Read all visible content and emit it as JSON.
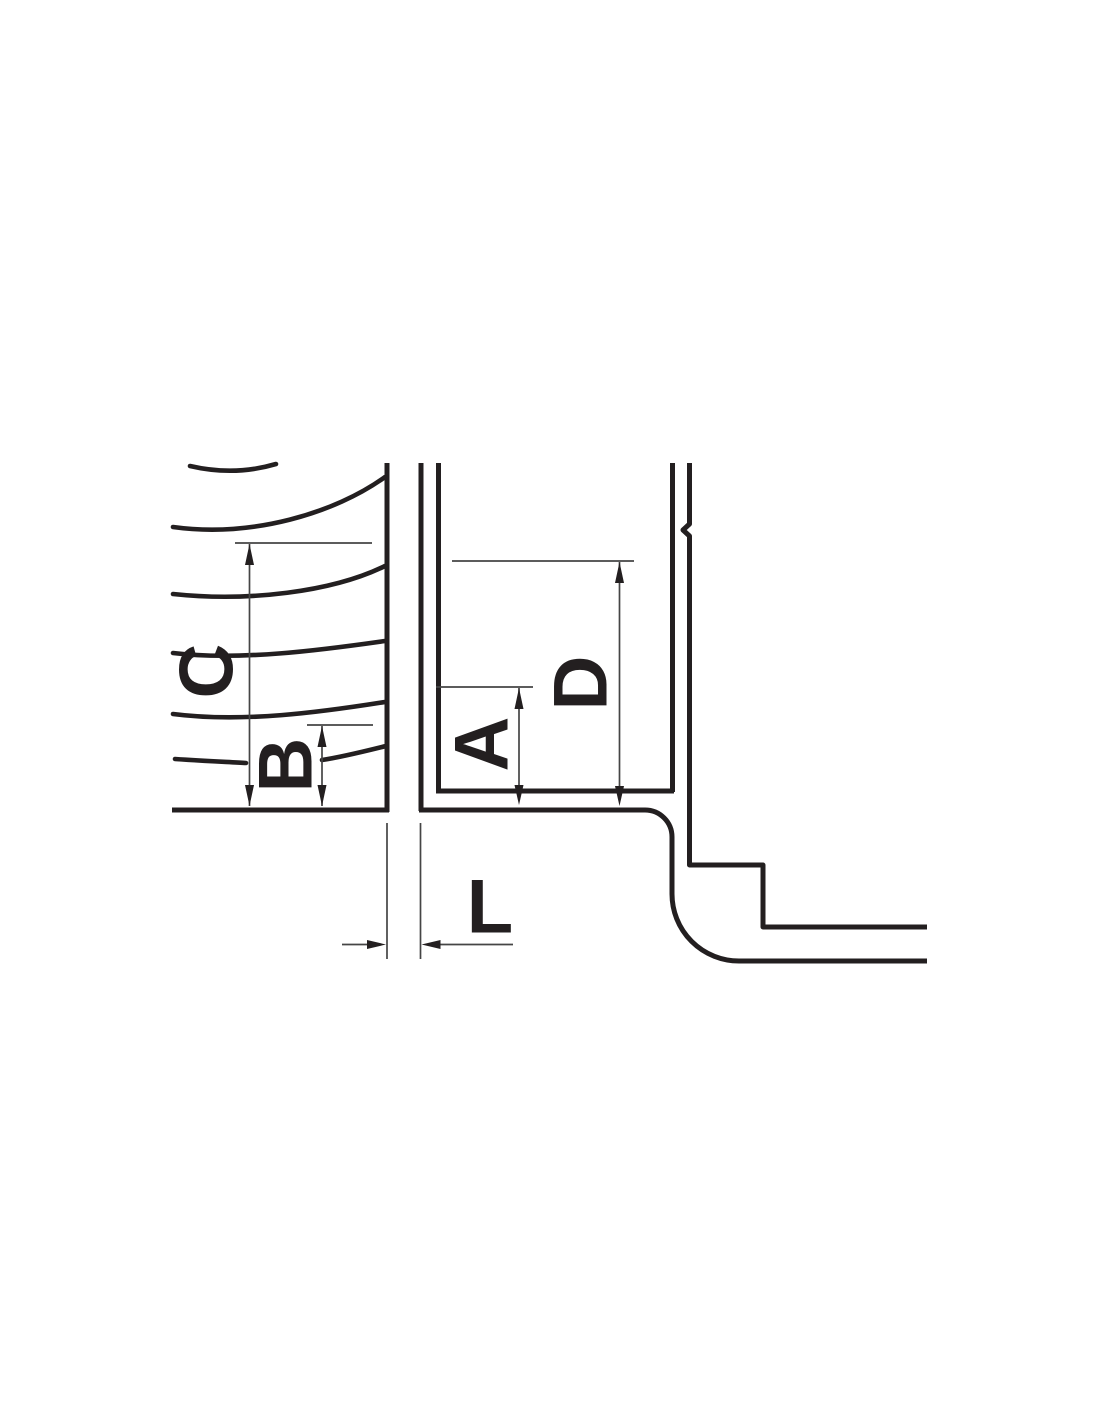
{
  "drawing": {
    "background_color": "#ffffff",
    "ink_color": "#231f20",
    "dimension_line_color": "#454545",
    "dimension_labels": {
      "a": "A",
      "b": "B",
      "c": "C",
      "d": "D",
      "l": "L"
    }
  }
}
